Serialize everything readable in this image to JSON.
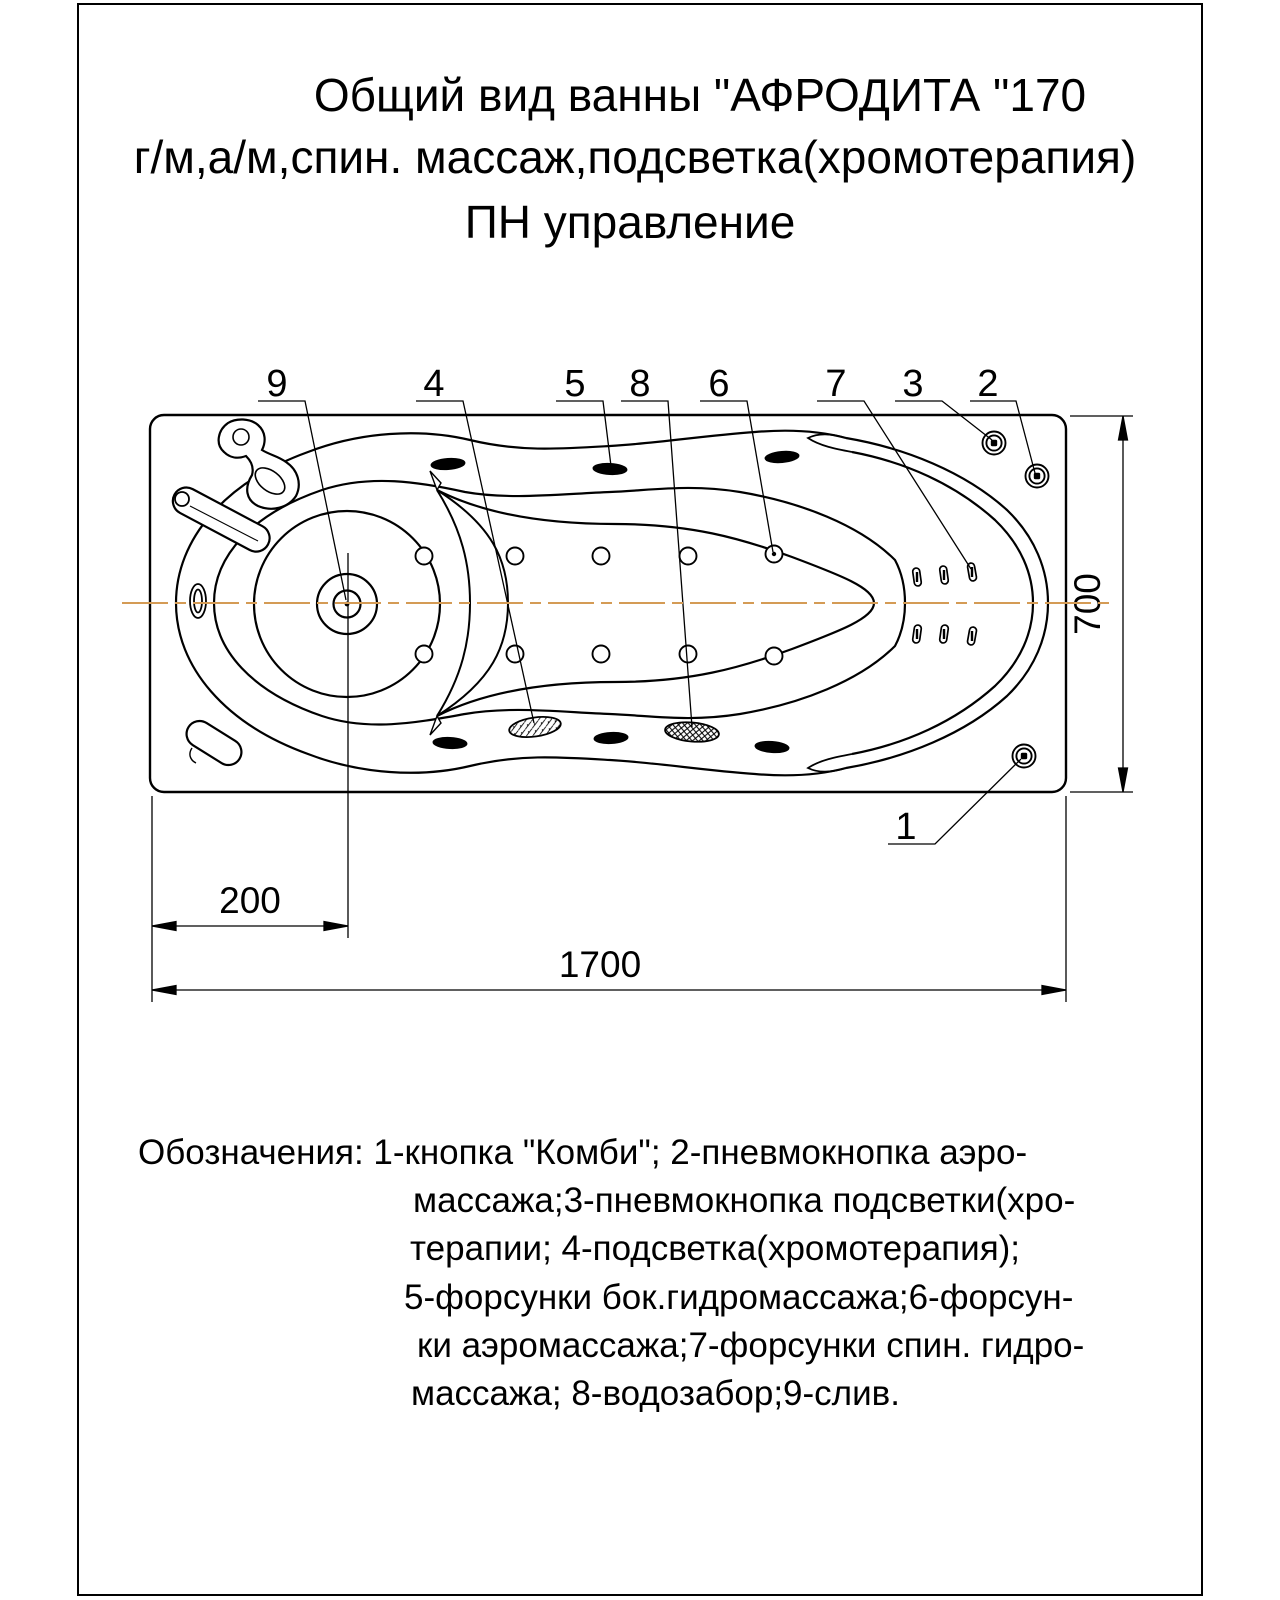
{
  "title": {
    "line1": "Общий вид ванны \"АФРОДИТА \"170",
    "line2": "г/м,а/м,спин. массаж,подсветка(хромотерапия)",
    "line3": "ПН управление"
  },
  "dimensions": {
    "overall_length": "1700",
    "overall_width": "700",
    "drain_offset": "200"
  },
  "callouts": {
    "n1": "1",
    "n2": "2",
    "n3": "3",
    "n4": "4",
    "n5": "5",
    "n6": "6",
    "n7": "7",
    "n8": "8",
    "n9": "9"
  },
  "legend": {
    "line1": "Обозначения: 1-кнопка \"Комби\"; 2-пневмокнопка аэро-",
    "line2": "массажа;3-пневмокнопка подсветки(хро-",
    "line3": "терапии; 4-подсветка(хромотерапия);",
    "line4": "5-форсунки бок.гидромассажа;6-форсун-",
    "line5": "ки аэромассажа;7-форсунки спин. гидро-",
    "line6": "массажа; 8-водозабор;9-слив."
  },
  "colors": {
    "line": "#000000",
    "centerline": "#D49B55",
    "background": "#FFFFFF"
  }
}
